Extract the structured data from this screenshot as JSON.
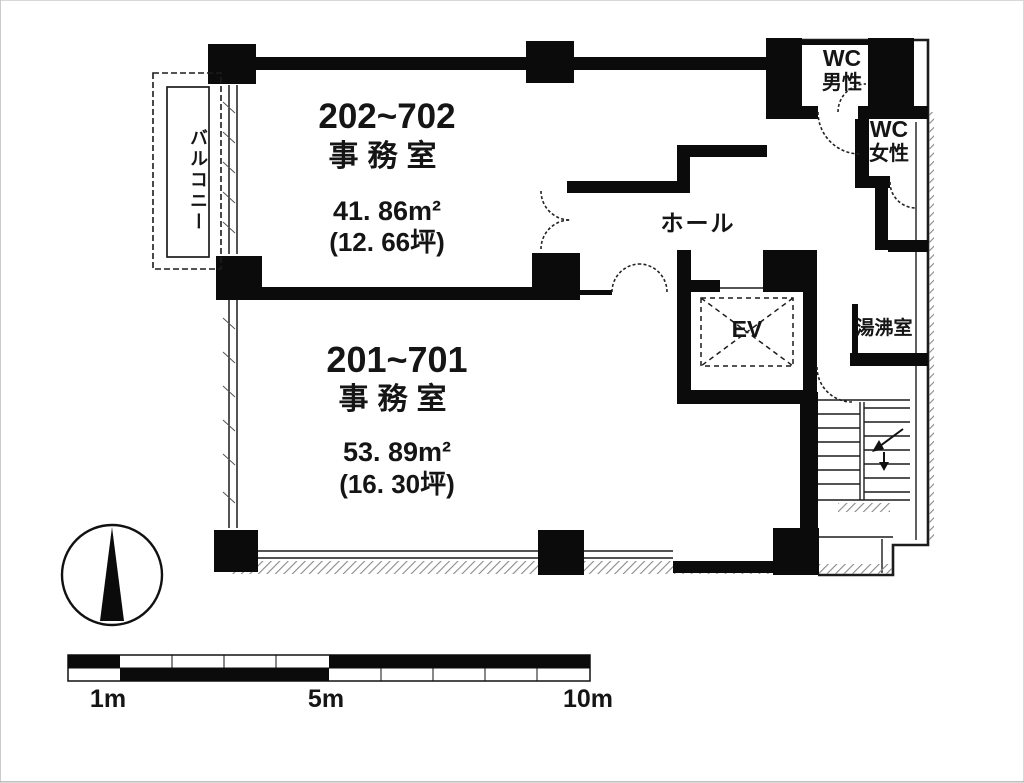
{
  "plan": {
    "title": "floor-plan",
    "rooms": [
      {
        "name": "202~702",
        "type": "事務室",
        "area_m2": "41. 86m²",
        "area_tsubo": "(12. 66坪)"
      },
      {
        "name": "201~701",
        "type": "事務室",
        "area_m2": "53. 89m²",
        "area_tsubo": "(16. 30坪)"
      }
    ],
    "labels": {
      "balcony": "バルコニー",
      "hall": "ホール",
      "elevator": "EV",
      "wc_male_line1": "WC",
      "wc_male_line2": "男性",
      "wc_female_line1": "WC",
      "wc_female_line2": "女性",
      "kitchenette": "湯沸室"
    },
    "scale_bar": {
      "mark_1m": "1m",
      "mark_5m": "5m",
      "mark_10m": "10m"
    },
    "colors": {
      "wall": "#0b0b0b",
      "line": "#1c1c1c",
      "hatch": "#8a8a8a",
      "background": "#ffffff"
    }
  }
}
